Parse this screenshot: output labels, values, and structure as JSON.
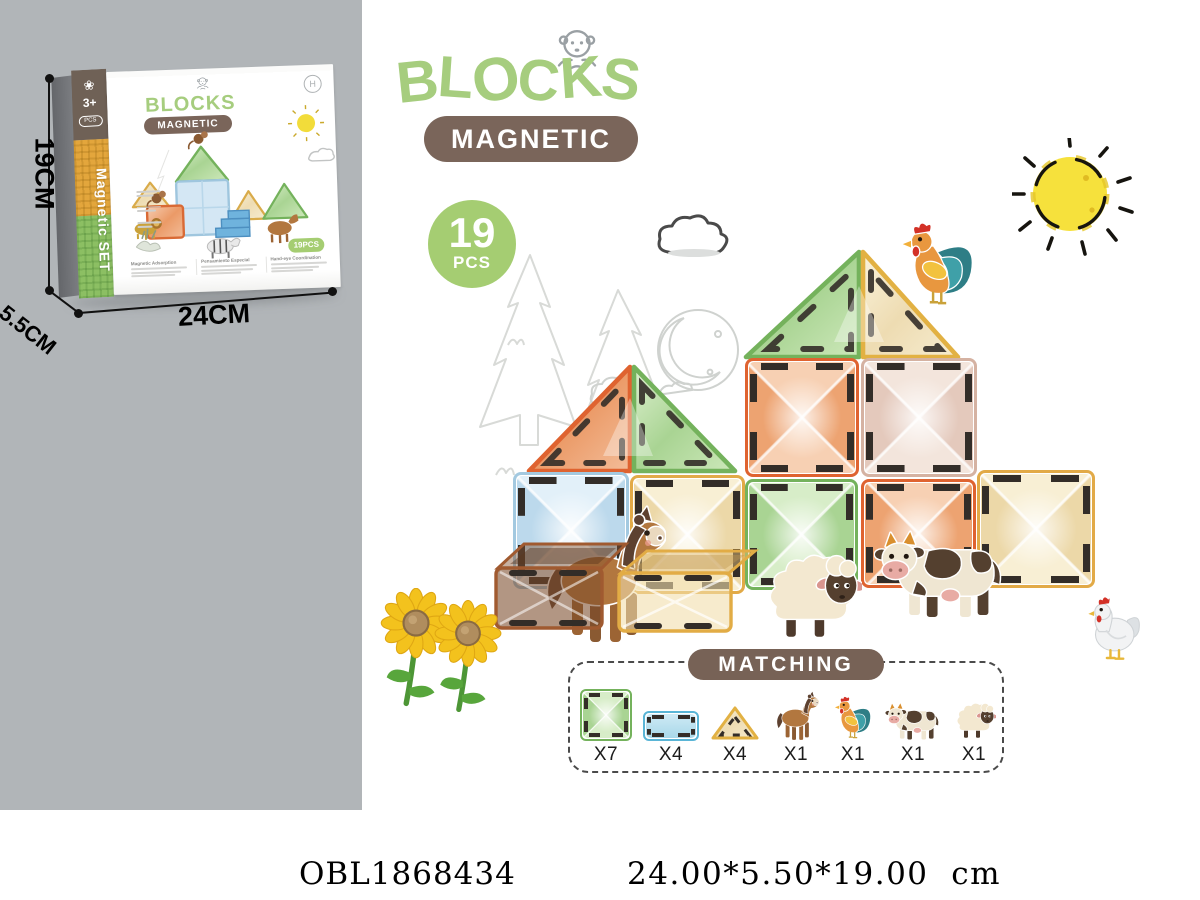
{
  "panel": {
    "dim_height": "19CM",
    "dim_width": "24CM",
    "dim_depth": "5.5CM"
  },
  "box": {
    "brand": "BLOCKS",
    "subbrand": "MAGNETIC",
    "age_badge": "3+",
    "age_oval": "PCS",
    "spine_text": "Magnetic SET",
    "pcs_badge": "19PCS",
    "features": [
      "Magnetic Adsorption",
      "Pensamiento Especial",
      "Hand-eye Coordination"
    ]
  },
  "header": {
    "brand": "BLOCKS",
    "subbrand": "MAGNETIC",
    "pcs_number": "19",
    "pcs_unit": "PCS"
  },
  "matching": {
    "title": "MATCHING",
    "items": [
      {
        "icon": "green-square-tile",
        "count": "X7"
      },
      {
        "icon": "blue-rect-tile",
        "count": "X4"
      },
      {
        "icon": "yellow-triangle-tile",
        "count": "X4"
      },
      {
        "icon": "horse",
        "count": "X1"
      },
      {
        "icon": "rooster",
        "count": "X1"
      },
      {
        "icon": "cow",
        "count": "X1"
      },
      {
        "icon": "sheep",
        "count": "X1"
      }
    ]
  },
  "footer": {
    "sku": "OBL1868434",
    "size": "24.00*5.50*19.00  cm"
  },
  "palette": {
    "logo_green": "#a6cd7e",
    "pill_brown": "#7a655a",
    "badge_green": "#a5cd72",
    "matching_brown": "#776256",
    "panel_gray": "#b1b5b8",
    "sun_yellow": "#f6e13c",
    "text_dark": "#1c1c1c"
  }
}
